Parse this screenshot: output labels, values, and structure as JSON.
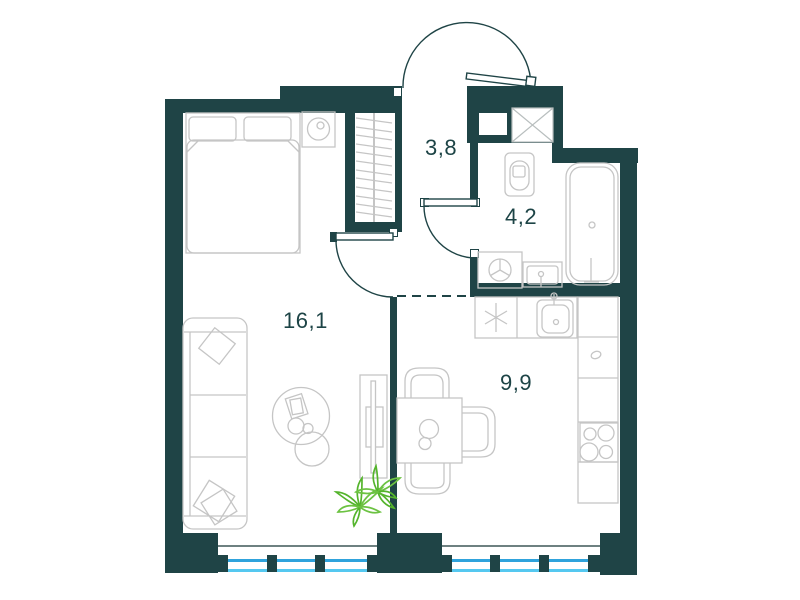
{
  "floor_plan": {
    "rooms": [
      {
        "name": "living-room",
        "area_label": "16,1"
      },
      {
        "name": "hallway",
        "area_label": "3,8"
      },
      {
        "name": "bathroom",
        "area_label": "4,2"
      },
      {
        "name": "kitchen",
        "area_label": "9,9"
      }
    ],
    "fixtures": [
      "bed",
      "pillows",
      "nightstand-with-clock",
      "wardrobe",
      "sofa",
      "sofa-cushions",
      "coffee-table",
      "tv-stand",
      "plant",
      "dining-table",
      "dining-chairs",
      "kitchen-counter",
      "appliance-star-symbol",
      "kitchen-sink",
      "cooktop",
      "toilet",
      "bathtub",
      "washing-machine",
      "bathroom-sink",
      "ventilation-shaft",
      "entrance-door",
      "interior-door",
      "windows"
    ],
    "colors": {
      "wall": "#1f4446",
      "furn": "#c5c5c5",
      "shaft": "#b8bebe",
      "sill": "#6e8181",
      "glass1": "#2fa3dc",
      "glass2": "#55c8f0",
      "plant": "#54b42c",
      "plant2": "#6cc242",
      "text": "#1d4446",
      "bg": "#ffffff"
    }
  }
}
